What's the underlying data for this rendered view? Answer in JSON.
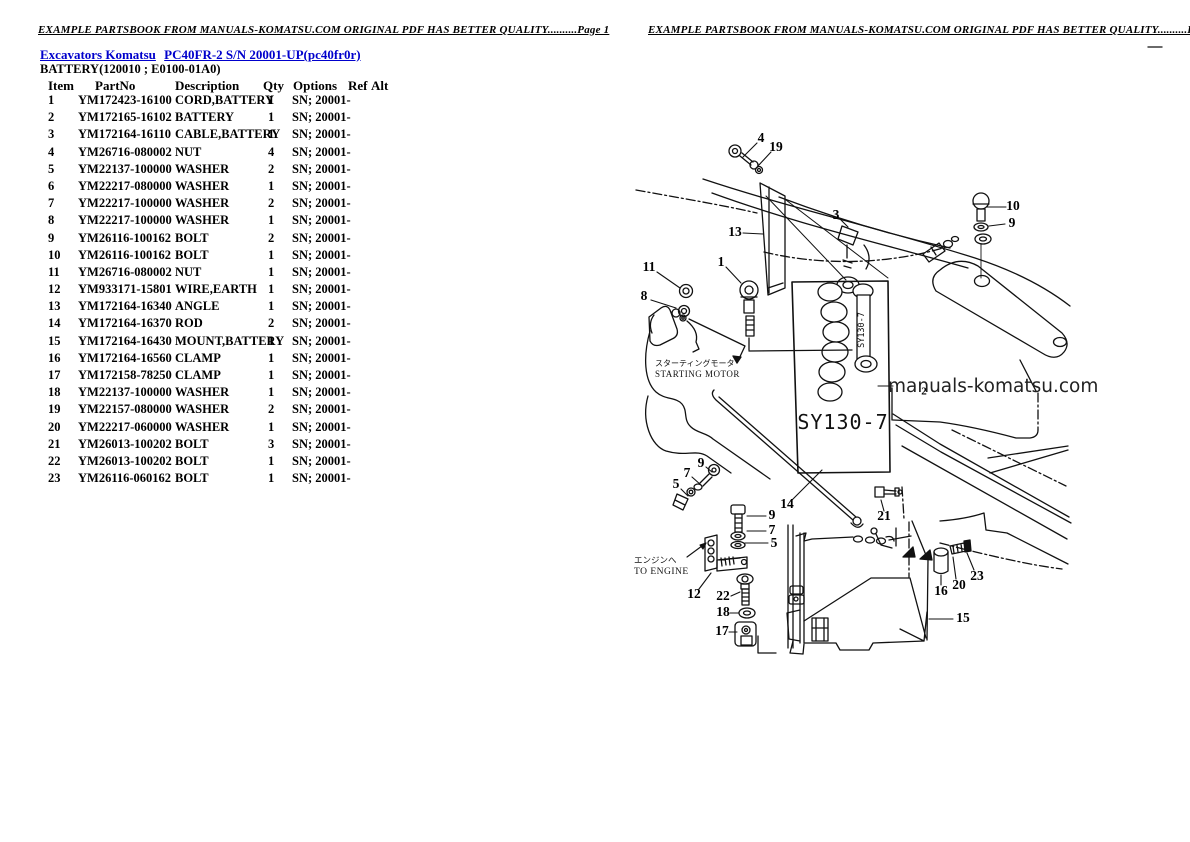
{
  "pages": {
    "left": {
      "header": "EXAMPLE PARTSBOOK FROM MANUALS-KOMATSU.COM ORIGINAL PDF HAS BETTER QUALITY..........Page 1"
    },
    "right": {
      "header": "EXAMPLE PARTSBOOK FROM MANUALS-KOMATSU.COM ORIGINAL PDF HAS BETTER QUALITY..........Page 2"
    }
  },
  "breadcrumb": {
    "link_category": "Excavators Komatsu",
    "link_model": "PC40FR-2 S/N 20001-UP(pc40fr0r)"
  },
  "section_title": "BATTERY(120010 ; E0100-01A0)",
  "parts_table": {
    "columns": {
      "item": "Item",
      "partno": "PartNo",
      "description": "Description",
      "qty": "Qty",
      "options": "Options",
      "ref": "Ref",
      "alt": "Alt"
    },
    "rows": [
      [
        "1",
        "YM172423-16100",
        "CORD,BATTERY",
        "1",
        "SN; 20001-"
      ],
      [
        "2",
        "YM172165-16102",
        "BATTERY",
        "1",
        "SN; 20001-"
      ],
      [
        "3",
        "YM172164-16110",
        "CABLE,BATTERY",
        "1",
        "SN; 20001-"
      ],
      [
        "4",
        "YM26716-080002",
        "NUT",
        "4",
        "SN; 20001-"
      ],
      [
        "5",
        "YM22137-100000",
        "WASHER",
        "2",
        "SN; 20001-"
      ],
      [
        "6",
        "YM22217-080000",
        "WASHER",
        "1",
        "SN; 20001-"
      ],
      [
        "7",
        "YM22217-100000",
        "WASHER",
        "2",
        "SN; 20001-"
      ],
      [
        "8",
        "YM22217-100000",
        "WASHER",
        "1",
        "SN; 20001-"
      ],
      [
        "9",
        "YM26116-100162",
        "BOLT",
        "2",
        "SN; 20001-"
      ],
      [
        "10",
        "YM26116-100162",
        "BOLT",
        "1",
        "SN; 20001-"
      ],
      [
        "11",
        "YM26716-080002",
        "NUT",
        "1",
        "SN; 20001-"
      ],
      [
        "12",
        "YM933171-15801",
        "WIRE,EARTH",
        "1",
        "SN; 20001-"
      ],
      [
        "13",
        "YM172164-16340",
        "ANGLE",
        "1",
        "SN; 20001-"
      ],
      [
        "14",
        "YM172164-16370",
        "ROD",
        "2",
        "SN; 20001-"
      ],
      [
        "15",
        "YM172164-16430",
        "MOUNT,BATTERY",
        "1",
        "SN; 20001-"
      ],
      [
        "16",
        "YM172164-16560",
        "CLAMP",
        "1",
        "SN; 20001-"
      ],
      [
        "17",
        "YM172158-78250",
        "CLAMP",
        "1",
        "SN; 20001-"
      ],
      [
        "18",
        "YM22137-100000",
        "WASHER",
        "1",
        "SN; 20001-"
      ],
      [
        "19",
        "YM22157-080000",
        "WASHER",
        "2",
        "SN; 20001-"
      ],
      [
        "20",
        "YM22217-060000",
        "WASHER",
        "1",
        "SN; 20001-"
      ],
      [
        "21",
        "YM26013-100202",
        "BOLT",
        "3",
        "SN; 20001-"
      ],
      [
        "22",
        "YM26013-100202",
        "BOLT",
        "1",
        "SN; 20001-"
      ],
      [
        "23",
        "YM26116-060162",
        "BOLT",
        "1",
        "SN; 20001-"
      ]
    ]
  },
  "diagram": {
    "labels": {
      "battery_model_large": "SY130-7",
      "battery_model_small": "SY130-7",
      "starting_motor_jp": "スターティングモータ",
      "starting_motor_en": "STARTING MOTOR",
      "to_engine_jp": "エンジンへ",
      "to_engine_en": "TO ENGINE",
      "watermark": "manuals-komatsu.com"
    },
    "callouts": [
      {
        "n": "4",
        "x": 761,
        "y": 139
      },
      {
        "n": "19",
        "x": 776,
        "y": 148
      },
      {
        "n": "13",
        "x": 735,
        "y": 233
      },
      {
        "n": "3",
        "x": 836,
        "y": 216
      },
      {
        "n": "1",
        "x": 721,
        "y": 263
      },
      {
        "n": "11",
        "x": 649,
        "y": 268
      },
      {
        "n": "8",
        "x": 644,
        "y": 297
      },
      {
        "n": "10",
        "x": 1013,
        "y": 207
      },
      {
        "n": "9",
        "x": 1012,
        "y": 224
      },
      {
        "n": "2",
        "x": 924,
        "y": 392,
        "s": 11
      },
      {
        "n": "9",
        "x": 701,
        "y": 464
      },
      {
        "n": "7",
        "x": 687,
        "y": 474
      },
      {
        "n": "5",
        "x": 676,
        "y": 485
      },
      {
        "n": "14",
        "x": 787,
        "y": 505
      },
      {
        "n": "9",
        "x": 772,
        "y": 516
      },
      {
        "n": "7",
        "x": 772,
        "y": 531
      },
      {
        "n": "5",
        "x": 774,
        "y": 544
      },
      {
        "n": "12",
        "x": 694,
        "y": 595
      },
      {
        "n": "22",
        "x": 723,
        "y": 597
      },
      {
        "n": "18",
        "x": 723,
        "y": 613
      },
      {
        "n": "17",
        "x": 722,
        "y": 632
      },
      {
        "n": "21",
        "x": 884,
        "y": 517
      },
      {
        "n": "16",
        "x": 941,
        "y": 592
      },
      {
        "n": "20",
        "x": 959,
        "y": 586
      },
      {
        "n": "23",
        "x": 977,
        "y": 577
      },
      {
        "n": "15",
        "x": 963,
        "y": 619
      }
    ]
  },
  "colors": {
    "link": "#0000cc",
    "ink": "#111111",
    "watermark": "#222222"
  }
}
